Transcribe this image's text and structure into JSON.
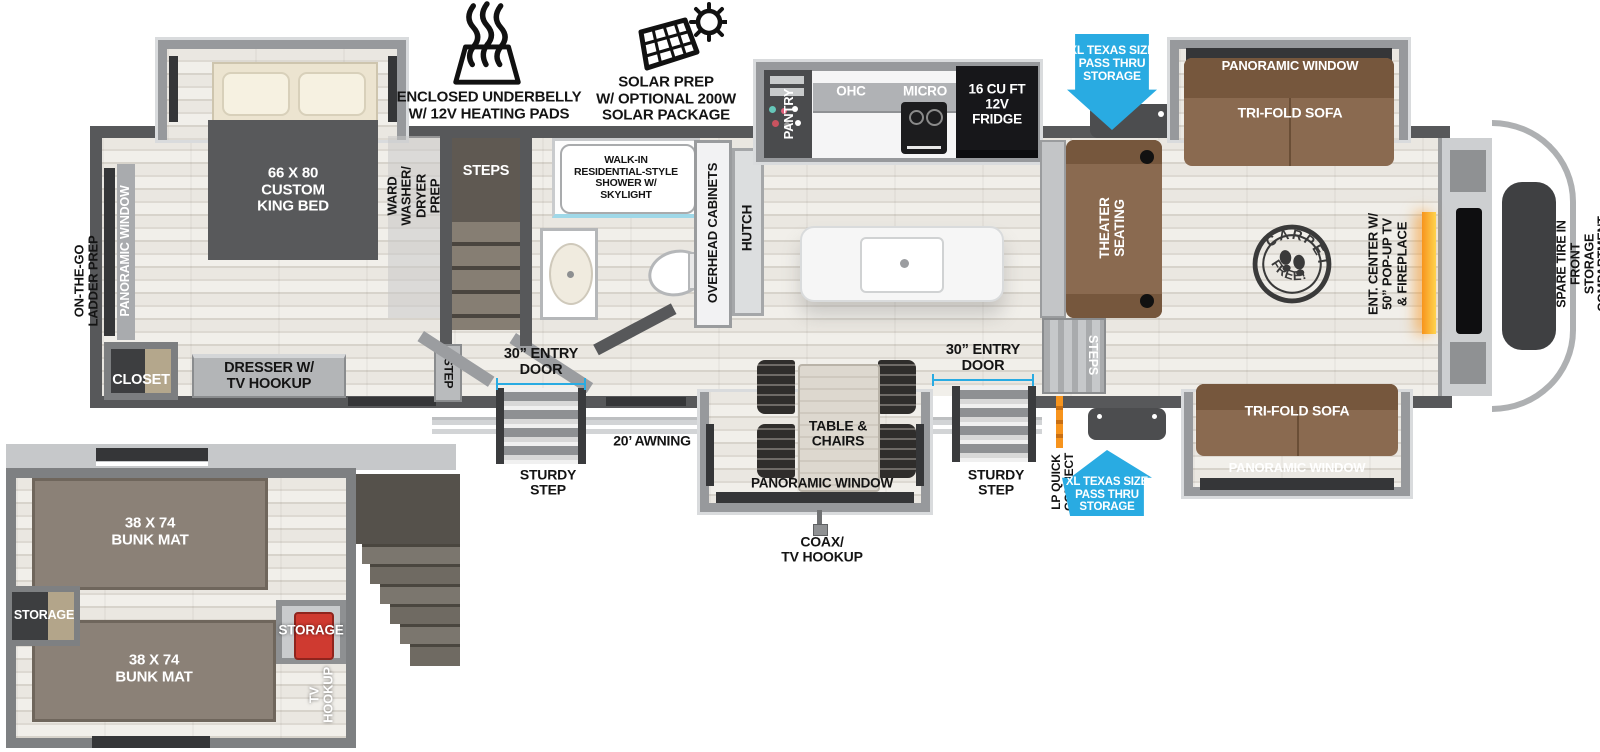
{
  "colors": {
    "accent_blue": "#29abe2",
    "wall_gray": "#57585a",
    "sofa_brown": "#8a6a50",
    "fireplace_orange": "#f7941d",
    "storage_red": "#cf3a30"
  },
  "legend": {
    "underbelly": "ENCLOSED UNDERBELLY\nW/ 12V HEATING PADS",
    "solar": "SOLAR PREP\nW/ OPTIONAL 200W\nSOLAR PACKAGE"
  },
  "exterior": {
    "pass_thru": "XL TEXAS SIZE\nPASS THRU\nSTORAGE",
    "awning": "20’ AWNING",
    "coax": "COAX/\nTV HOOKUP",
    "lp_quick": "LP QUICK\nCONNECT",
    "entry_door": "30” ENTRY\nDOOR",
    "sturdy_step": "STURDY\nSTEP",
    "ladder_prep": "ON-THE-GO\nLADDER PREP",
    "spare_tire": "SPARE TIRE IN FRONT\nSTORAGE COMPARTMENT"
  },
  "bedroom": {
    "panoramic_window": "PANORAMIC WINDOW",
    "bed": "66 X 80\nCUSTOM\nKING BED",
    "ward": "WARD\nWASHER/\nDRYER\nPREP",
    "closet": "CLOSET",
    "dresser": "DRESSER W/\nTV HOOKUP",
    "step": "STEP"
  },
  "bath": {
    "steps": "STEPS",
    "shower": "WALK-IN\nRESIDENTIAL-STYLE\nSHOWER W/\nSKYLIGHT",
    "overhead_cabinets": "OVERHEAD CABINETS",
    "hutch": "HUTCH"
  },
  "kitchen": {
    "pantry": "PANTRY",
    "ohc": "OHC",
    "micro": "MICRO",
    "fridge": "16 CU FT\n12V\nFRIDGE"
  },
  "living": {
    "theater": "THEATER\nSEATING",
    "steps": "STEPS",
    "trifold": "TRI-FOLD SOFA",
    "panoramic_window": "PANORAMIC WINDOW",
    "ent_center": "ENT. CENTER W/\n50” POP-UP TV\n& FIREPLACE",
    "carpet_top": "CARPET",
    "carpet_bottom": "FREE!"
  },
  "dinette": {
    "table": "TABLE &\nCHAIRS",
    "panoramic_window": "PANORAMIC WINDOW"
  },
  "bunk": {
    "mat": "38 X 74\nBUNK MAT",
    "storage": "STORAGE",
    "tv_hookup": "TV\nHOOKUP"
  }
}
